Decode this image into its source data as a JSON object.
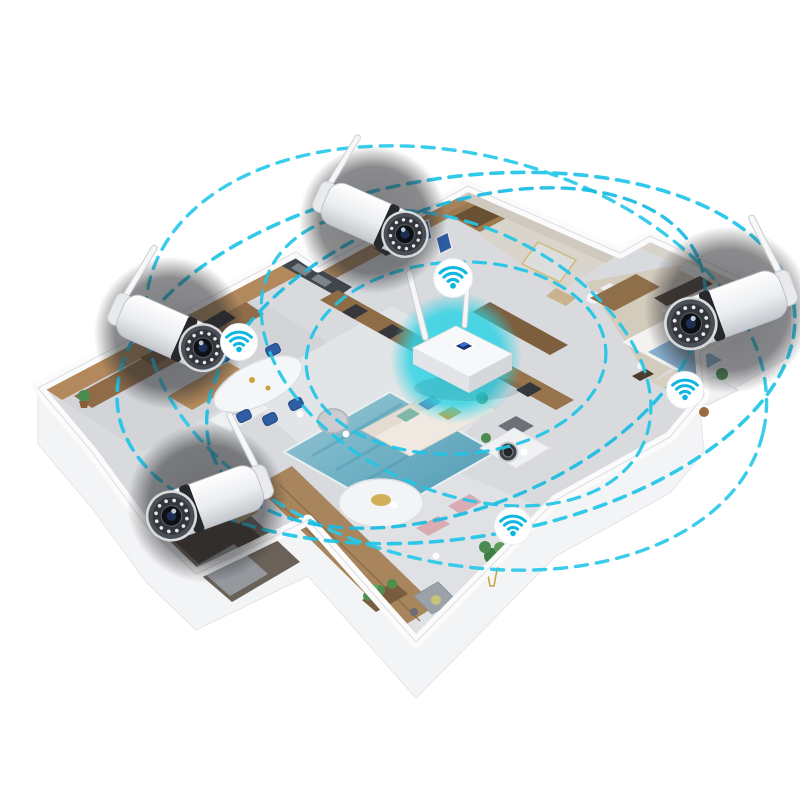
{
  "meta": {
    "description": "Isometric cutaway apartment floorplan showing a wireless security camera system: central WiFi router with cyan glow, four bullet cameras, four WiFi signal badges and dashed coverage rings",
    "background": "#ffffff"
  },
  "palette": {
    "accent_cyan": "#1fc4e7",
    "router_glow": "#2ed3e4",
    "wifi_glyph": "#0fb6e2",
    "camera_halo": "#2a2b2e",
    "wall_white": "#fbfbfc",
    "floor_gray": "#d8dade",
    "wood": "#a8825a",
    "rug_teal": "#6fb0c4",
    "chair_navy": "#2f5ea5",
    "bedding_blue": "#7ba6c9",
    "pillow_orange": "#c8803f"
  },
  "network": {
    "router": {
      "id": "wifi-router",
      "x": 456,
      "y": 358,
      "scale": 1.0,
      "glow_radius": 66
    },
    "coverage_rings": [
      {
        "id": "coverage-ring-1",
        "cx": 456,
        "cy": 358,
        "rx": 342,
        "ry": 180,
        "rotation": -9,
        "color": "#1fc4e7",
        "width": 3.6
      },
      {
        "id": "coverage-ring-2",
        "cx": 456,
        "cy": 358,
        "rx": 316,
        "ry": 204,
        "rotation": 14,
        "color": "#29c9e9",
        "width": 3.4
      },
      {
        "id": "coverage-ring-3",
        "cx": 456,
        "cy": 358,
        "rx": 262,
        "ry": 150,
        "rotation": -22,
        "color": "#19bce2",
        "width": 3.4
      },
      {
        "id": "coverage-ring-4",
        "cx": 456,
        "cy": 358,
        "rx": 206,
        "ry": 132,
        "rotation": 25,
        "color": "#22c5e6",
        "width": 3.2
      },
      {
        "id": "coverage-ring-5",
        "cx": 456,
        "cy": 358,
        "rx": 150,
        "ry": 96,
        "rotation": -3,
        "color": "#1fc4e7",
        "width": 3.2
      }
    ],
    "cameras": [
      {
        "id": "camera-entry",
        "x": 373,
        "y": 220,
        "rotation": 24,
        "scale": 1.0,
        "mirrored": false
      },
      {
        "id": "camera-kitchen",
        "x": 170,
        "y": 333,
        "rotation": 24,
        "scale": 1.03,
        "mirrored": false
      },
      {
        "id": "camera-study",
        "x": 207,
        "y": 503,
        "rotation": 20,
        "scale": 1.08,
        "mirrored": true
      },
      {
        "id": "camera-bedroom",
        "x": 728,
        "y": 310,
        "rotation": 20,
        "scale": 1.13,
        "mirrored": true
      }
    ],
    "wifi_signals": [
      {
        "id": "wifi-signal-hallway",
        "x": 453,
        "y": 278,
        "scale": 1.05
      },
      {
        "id": "wifi-signal-dining",
        "x": 239,
        "y": 342,
        "scale": 1.0
      },
      {
        "id": "wifi-signal-bedroom",
        "x": 685,
        "y": 390,
        "scale": 1.0
      },
      {
        "id": "wifi-signal-living-room",
        "x": 513,
        "y": 526,
        "scale": 1.0
      }
    ]
  }
}
